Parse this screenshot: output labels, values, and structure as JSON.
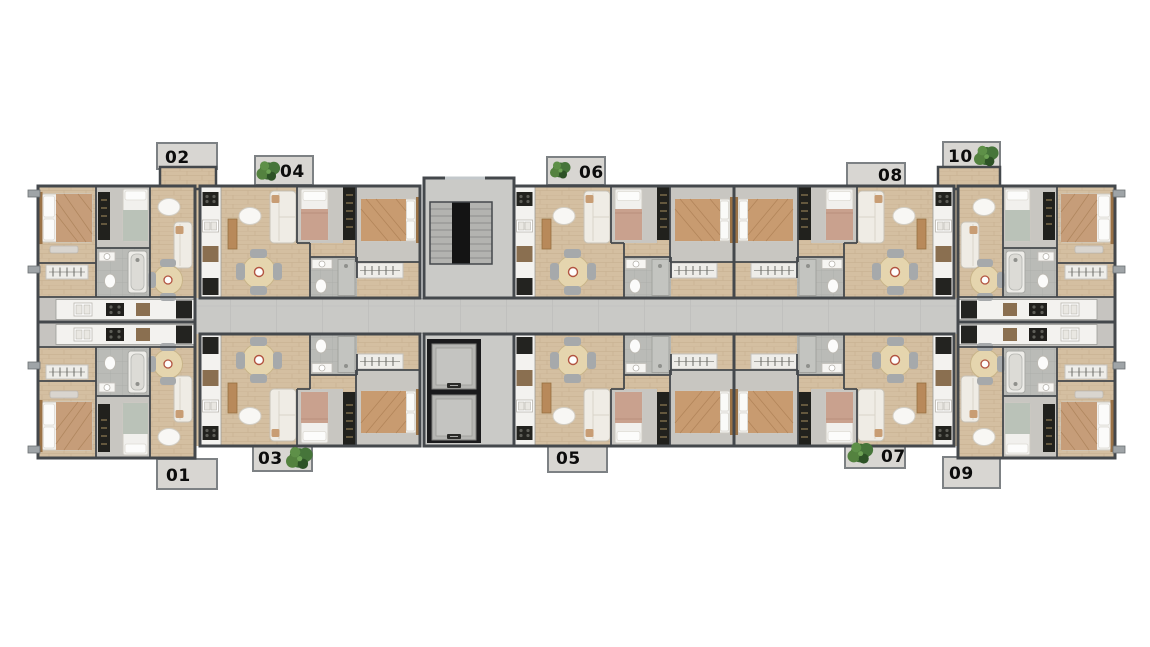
{
  "page": {
    "type": "residential-building-floor-plan",
    "background": "#ffffff"
  },
  "units": [
    {
      "label": "01",
      "side": "bottom",
      "has_plant": false
    },
    {
      "label": "02",
      "side": "top",
      "has_plant": false
    },
    {
      "label": "03",
      "side": "bottom",
      "has_plant": true
    },
    {
      "label": "04",
      "side": "top",
      "has_plant": true
    },
    {
      "label": "05",
      "side": "bottom",
      "has_plant": false
    },
    {
      "label": "06",
      "side": "top",
      "has_plant": true
    },
    {
      "label": "07",
      "side": "bottom",
      "has_plant": true
    },
    {
      "label": "08",
      "side": "top",
      "has_plant": false
    },
    {
      "label": "09",
      "side": "bottom",
      "has_plant": false
    },
    {
      "label": "10",
      "side": "top",
      "has_plant": true
    }
  ],
  "core": {
    "stair_flights": 2,
    "elevators": 2
  },
  "palette": {
    "wall": "#44484c",
    "wood_floor": "#d4bfa1",
    "gray_floor": "#c8c6c1",
    "bath_tile": "#babbb7",
    "corridor": "#c9c9c6",
    "counter": "#f3f2ef",
    "label_tab": "#d8d6d2",
    "label_text": "#0c0c0c",
    "plant_green": "#3c6a33",
    "bed_tan": "#c89b70",
    "bed_pink": "#c9a18e",
    "bed_sage": "#bac2b8",
    "sofa": "#efece5",
    "dining_table": "#e5d5ae",
    "appliance_dark": "#232320"
  }
}
